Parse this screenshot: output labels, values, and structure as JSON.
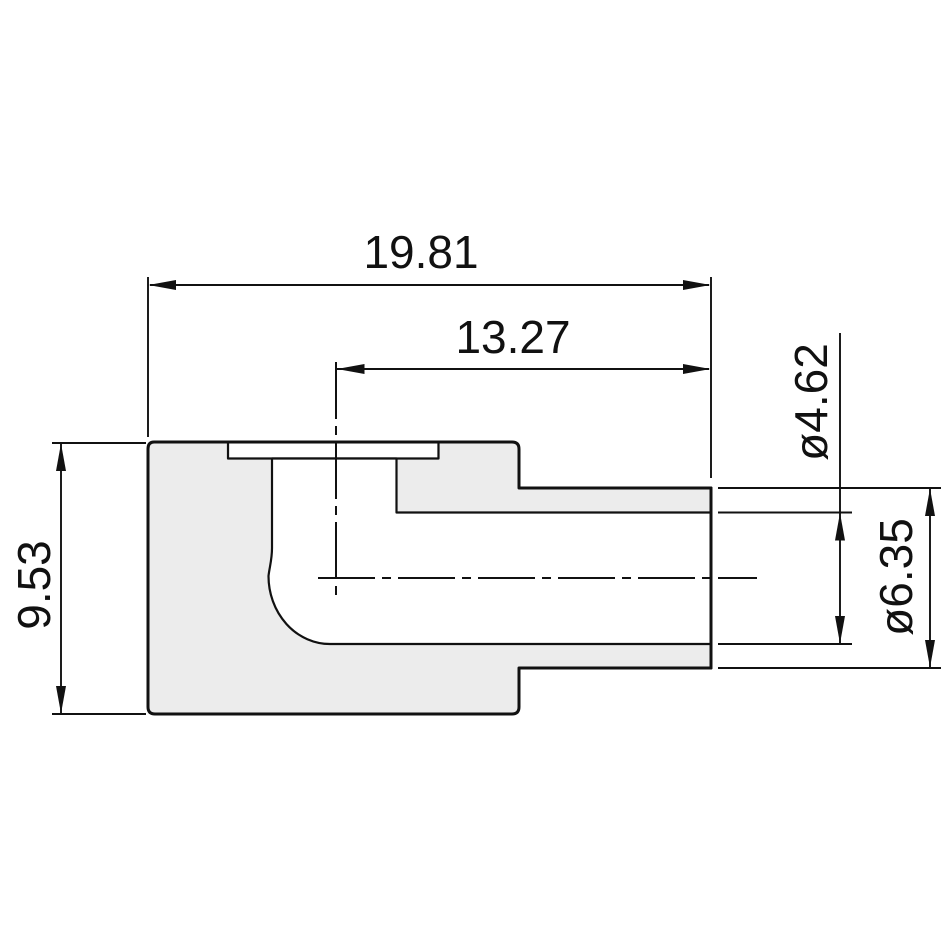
{
  "drawing": {
    "colors": {
      "line": "#111111",
      "section_fill": "#ececec",
      "background": "#ffffff"
    },
    "dimensions": {
      "overall_length": "19.81",
      "port_to_end_length": "13.27",
      "body_height": "9.53",
      "bore_diameter": "ø4.62",
      "tube_outer_diameter": "ø6.35"
    }
  }
}
